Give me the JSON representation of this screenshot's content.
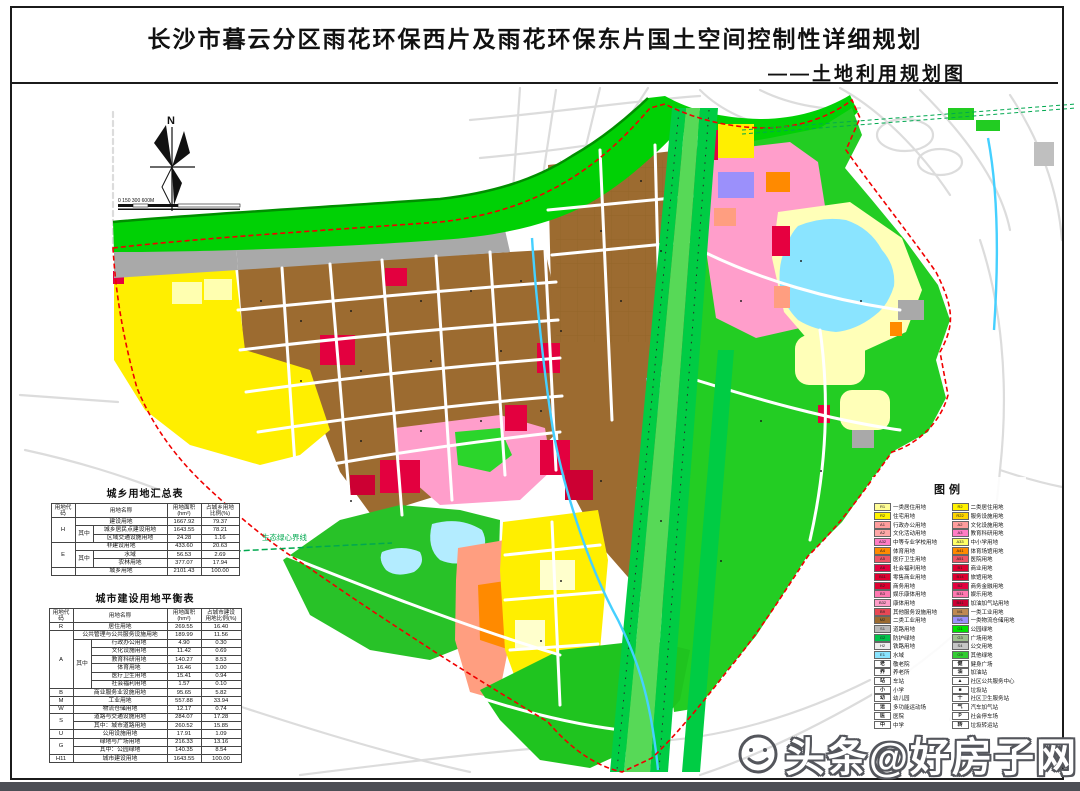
{
  "header": {
    "title": "长沙市暮云分区雨花环保西片及雨花环保东片国土空间控制性详细规划",
    "subtitle": "——土地利用规划图"
  },
  "map": {
    "north_label": "N",
    "scale_label": "0  150  300            600M",
    "green_heart_label": "生态绿心界线"
  },
  "summary_table": {
    "title": "城乡用地汇总表",
    "header": [
      {
        "t": "用地代码"
      },
      {
        "t": "用地名称",
        "cs": 2
      },
      {
        "t": "用地面积\n(hm²)"
      },
      {
        "t": "占城乡用地\n比例(%)"
      }
    ],
    "rows": [
      [
        {
          "t": "H",
          "rs": 3
        },
        {
          "t": "建设用地",
          "cs": 2
        },
        {
          "t": "1667.92"
        },
        {
          "t": "79.37"
        }
      ],
      [
        {
          "t": "其中",
          "rs": 2
        },
        {
          "t": "城乡居民点建设用地"
        },
        {
          "t": "1643.55"
        },
        {
          "t": "78.21"
        }
      ],
      [
        {
          "t": "区域交通设施用地"
        },
        {
          "t": "24.28"
        },
        {
          "t": "1.16"
        }
      ],
      [
        {
          "t": "E",
          "rs": 3
        },
        {
          "t": "非建设用地",
          "cs": 2
        },
        {
          "t": "433.60"
        },
        {
          "t": "20.63"
        }
      ],
      [
        {
          "t": "其中",
          "rs": 2
        },
        {
          "t": "水域"
        },
        {
          "t": "56.53"
        },
        {
          "t": "2.69"
        }
      ],
      [
        {
          "t": "农林用地"
        },
        {
          "t": "377.07"
        },
        {
          "t": "17.94"
        }
      ],
      [
        {
          "t": ""
        },
        {
          "t": "城乡用地",
          "cs": 2
        },
        {
          "t": "2101.43"
        },
        {
          "t": "100.00"
        }
      ]
    ]
  },
  "balance_table": {
    "title": "城市建设用地平衡表",
    "header": [
      {
        "t": "用地代码"
      },
      {
        "t": "用地名称",
        "cs": 2
      },
      {
        "t": "用地面积\n(hm²)"
      },
      {
        "t": "占城市建设\n用地比例(%)"
      }
    ],
    "rows": [
      [
        {
          "t": "R"
        },
        {
          "t": "居住用地",
          "cs": 2
        },
        {
          "t": "269.55"
        },
        {
          "t": "16.40"
        }
      ],
      [
        {
          "t": "A",
          "rs": 7
        },
        {
          "t": "公共管理与公共服务设施用地",
          "cs": 2
        },
        {
          "t": "189.99"
        },
        {
          "t": "11.56"
        }
      ],
      [
        {
          "t": "其中",
          "rs": 6
        },
        {
          "t": "行政办公用地"
        },
        {
          "t": "4.90"
        },
        {
          "t": "0.30"
        }
      ],
      [
        {
          "t": "文化设施用地"
        },
        {
          "t": "11.42"
        },
        {
          "t": "0.69"
        }
      ],
      [
        {
          "t": "教育科研用地"
        },
        {
          "t": "140.27"
        },
        {
          "t": "8.53"
        }
      ],
      [
        {
          "t": "体育用地"
        },
        {
          "t": "16.46"
        },
        {
          "t": "1.00"
        }
      ],
      [
        {
          "t": "医疗卫生用地"
        },
        {
          "t": "15.41"
        },
        {
          "t": "0.94"
        }
      ],
      [
        {
          "t": "社会福利用地"
        },
        {
          "t": "1.57"
        },
        {
          "t": "0.10"
        }
      ],
      [
        {
          "t": "B"
        },
        {
          "t": "商业服务业设施用地",
          "cs": 2
        },
        {
          "t": "95.65"
        },
        {
          "t": "5.82"
        }
      ],
      [
        {
          "t": "M"
        },
        {
          "t": "工业用地",
          "cs": 2
        },
        {
          "t": "557.88"
        },
        {
          "t": "33.94"
        }
      ],
      [
        {
          "t": "W"
        },
        {
          "t": "物流仓储用地",
          "cs": 2
        },
        {
          "t": "12.17"
        },
        {
          "t": "0.74"
        }
      ],
      [
        {
          "t": "S",
          "rs": 2
        },
        {
          "t": "道路与交通设施用地",
          "cs": 2
        },
        {
          "t": "284.07"
        },
        {
          "t": "17.28"
        }
      ],
      [
        {
          "t": "其中：城市道路用地",
          "cs": 2
        },
        {
          "t": "260.52"
        },
        {
          "t": "15.85"
        }
      ],
      [
        {
          "t": "U"
        },
        {
          "t": "公用设施用地",
          "cs": 2
        },
        {
          "t": "17.91"
        },
        {
          "t": "1.09"
        }
      ],
      [
        {
          "t": "G",
          "rs": 2
        },
        {
          "t": "绿地与广场用地",
          "cs": 2
        },
        {
          "t": "216.33"
        },
        {
          "t": "13.16"
        }
      ],
      [
        {
          "t": "其中：公园绿地",
          "cs": 2
        },
        {
          "t": "140.35"
        },
        {
          "t": "8.54"
        }
      ],
      [
        {
          "t": "H11"
        },
        {
          "t": "城市建设用地",
          "cs": 2
        },
        {
          "t": "1643.55"
        },
        {
          "t": "100.00"
        }
      ]
    ]
  },
  "legend": {
    "title": "图例",
    "left": [
      {
        "c": "R1",
        "l": "一类居住用地",
        "f": "#fffd96"
      },
      {
        "c": "R2",
        "l": "住宅用地",
        "f": "#fff200"
      },
      {
        "c": "A1",
        "l": "行政办公用地",
        "f": "#ff9d9d"
      },
      {
        "c": "A2",
        "l": "文化活动用地",
        "f": "#ffa8a8"
      },
      {
        "c": "A32",
        "l": "中等专业学校用地",
        "f": "#ff7dc5"
      },
      {
        "c": "A4",
        "l": "体育用地",
        "f": "#ff8a00"
      },
      {
        "c": "A5",
        "l": "医疗卫生用地",
        "f": "#ee5566"
      },
      {
        "c": "A6",
        "l": "社会福利用地",
        "f": "#e3003f"
      },
      {
        "c": "B11",
        "l": "零售商业用地",
        "f": "#dd0030"
      },
      {
        "c": "B2",
        "l": "商务用地",
        "f": "#dd0030"
      },
      {
        "c": "B3",
        "l": "娱乐康体用地",
        "f": "#ff77b0"
      },
      {
        "c": "B32",
        "l": "康体用地",
        "f": "#ff9dc8"
      },
      {
        "c": "B9",
        "l": "其他服务设施用地",
        "f": "#e84855"
      },
      {
        "c": "M2",
        "l": "二类工业用地",
        "f": "#9c6b30"
      },
      {
        "c": "S1",
        "l": "道路用地",
        "f": "#b9b9b9"
      },
      {
        "c": "G2",
        "l": "防护绿地",
        "f": "#00c24b"
      },
      {
        "c": "H2",
        "l": "铁路用地",
        "f": "#ededed"
      },
      {
        "c": "E1",
        "l": "水域",
        "f": "#8ae4ff"
      },
      {
        "i": "老",
        "l": "敬老院"
      },
      {
        "i": "养",
        "l": "养老所"
      },
      {
        "i": "站",
        "l": "车站"
      },
      {
        "i": "小",
        "l": "小学"
      },
      {
        "i": "幼",
        "l": "幼儿园"
      },
      {
        "i": "运",
        "l": "多功能运动场"
      },
      {
        "i": "医",
        "l": "医院"
      },
      {
        "i": "中",
        "l": "中学"
      }
    ],
    "right": [
      {
        "c": "R2",
        "l": "二类居住用地",
        "f": "#fff200"
      },
      {
        "c": "R22",
        "l": "服务设施用地",
        "f": "#ffd500"
      },
      {
        "c": "A2",
        "l": "文化设施用地",
        "f": "#ff9d9d"
      },
      {
        "c": "A3",
        "l": "教育科研用地",
        "f": "#ff7dc5"
      },
      {
        "c": "A33",
        "l": "中小学用地",
        "f": "#ffff66"
      },
      {
        "c": "A41",
        "l": "体育场馆用地",
        "f": "#ff8a00"
      },
      {
        "c": "A51",
        "l": "医院用地",
        "f": "#ee5566"
      },
      {
        "c": "B1",
        "l": "商业用地",
        "f": "#dd0030"
      },
      {
        "c": "B14",
        "l": "旅馆用地",
        "f": "#dd0030"
      },
      {
        "c": "B2",
        "l": "商务金融用地",
        "f": "#e3003f"
      },
      {
        "c": "B31",
        "l": "娱乐用地",
        "f": "#ff77b0"
      },
      {
        "c": "B41",
        "l": "加油加气站用地",
        "f": "#cc0033"
      },
      {
        "c": "M1",
        "l": "一类工业用地",
        "f": "#bf8952"
      },
      {
        "c": "W1",
        "l": "一类物流仓储用地",
        "f": "#9b90fb"
      },
      {
        "c": "G1",
        "l": "公园绿地",
        "f": "#00e400"
      },
      {
        "c": "G3",
        "l": "广场用地",
        "f": "#9fbf8f"
      },
      {
        "c": "S4",
        "l": "公交用地",
        "f": "#c6c6c6"
      },
      {
        "c": "G9",
        "l": "其他绿地",
        "f": "#33cc33"
      },
      {
        "i": "健",
        "l": "健身广场"
      },
      {
        "i": "油",
        "l": "加油站"
      },
      {
        "i": "▲",
        "l": "社区公共服务中心"
      },
      {
        "i": "■",
        "l": "垃圾站"
      },
      {
        "i": "十",
        "l": "社区卫生服务站"
      },
      {
        "i": "气",
        "l": "汽车加气站"
      },
      {
        "i": "P",
        "l": "社会停车场"
      },
      {
        "i": "转",
        "l": "垃圾转运站"
      }
    ]
  },
  "watermark": {
    "text": "头条@好房子网"
  }
}
